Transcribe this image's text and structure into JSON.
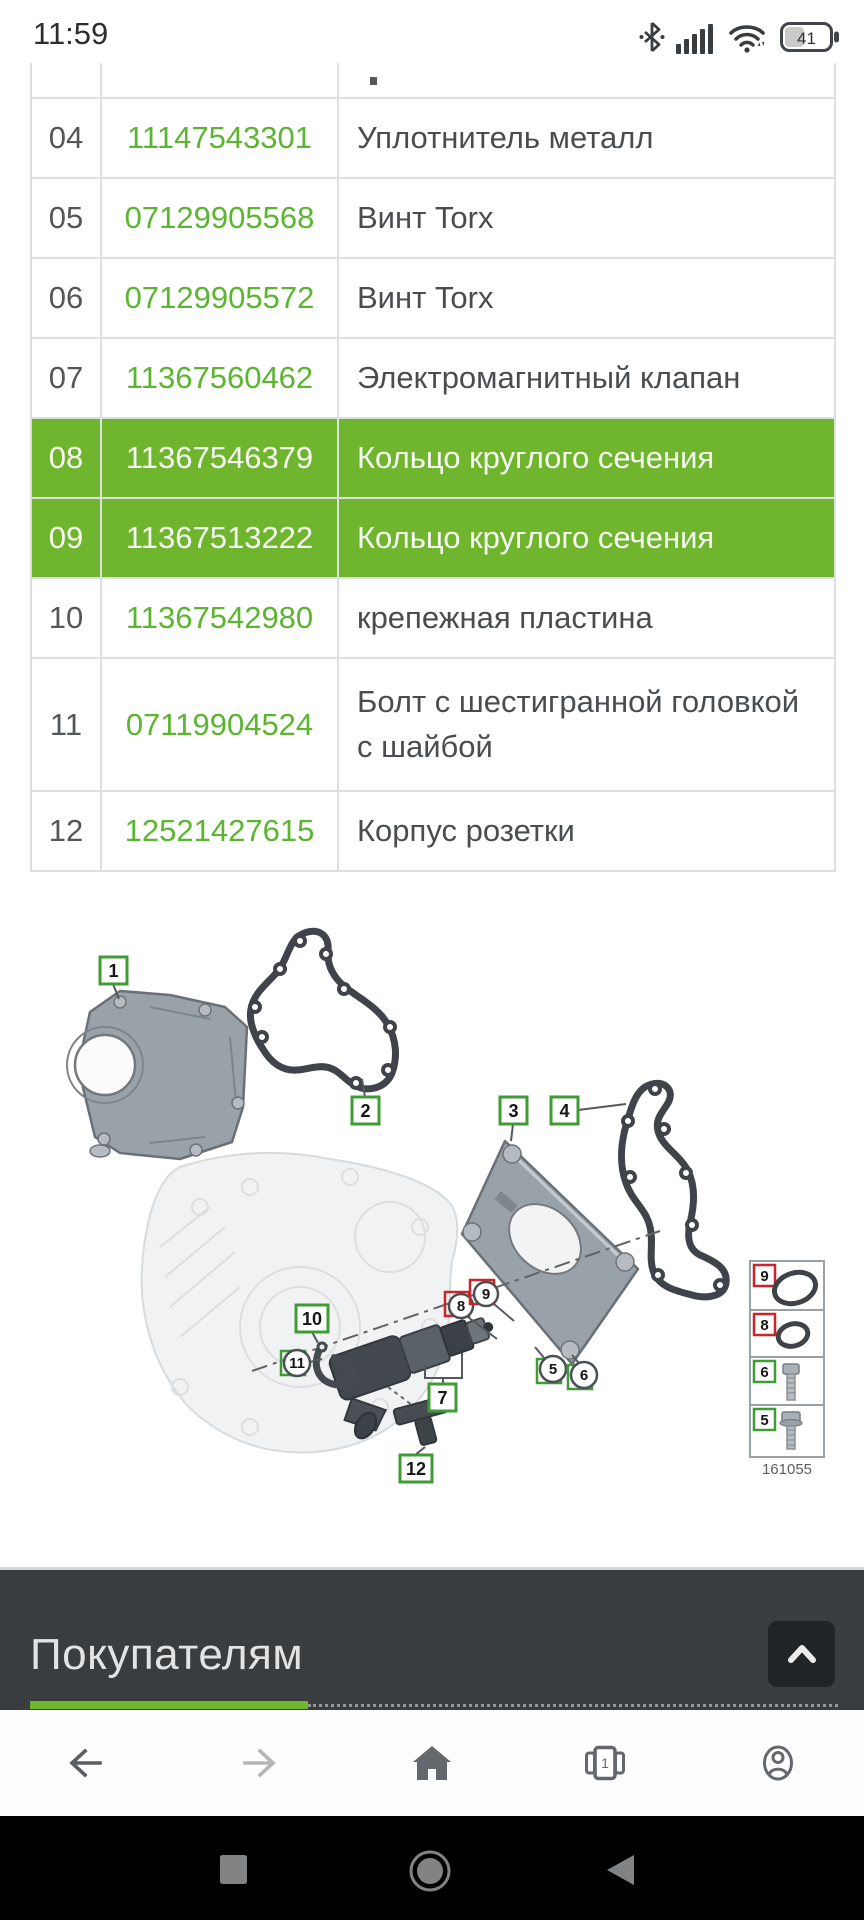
{
  "status_bar": {
    "time": "11:59",
    "battery_level": "41"
  },
  "parts_table": {
    "rows": [
      {
        "num": "04",
        "part_number": "11147543301",
        "description": "Уплотнитель металл",
        "highlighted": false
      },
      {
        "num": "05",
        "part_number": "07129905568",
        "description": "Винт Torx",
        "highlighted": false
      },
      {
        "num": "06",
        "part_number": "07129905572",
        "description": "Винт Torx",
        "highlighted": false
      },
      {
        "num": "07",
        "part_number": "11367560462",
        "description": "Электромагнитный клапан",
        "highlighted": false
      },
      {
        "num": "08",
        "part_number": "11367546379",
        "description": "Кольцо круглого сечения",
        "highlighted": true
      },
      {
        "num": "09",
        "part_number": "11367513222",
        "description": "Кольцо круглого сечения",
        "highlighted": true
      },
      {
        "num": "10",
        "part_number": "11367542980",
        "description": "крепежная пластина",
        "highlighted": false
      },
      {
        "num": "11",
        "part_number": "07119904524",
        "description": "Болт с шестигранной головкой с шайбой",
        "highlighted": false
      },
      {
        "num": "12",
        "part_number": "12521427615",
        "description": "Корпус розетки",
        "highlighted": false
      }
    ],
    "colors": {
      "accent_green": "#5cb531",
      "row_highlight": "#6fb52d"
    }
  },
  "diagram": {
    "callouts": {
      "n1": "1",
      "n2": "2",
      "n3": "3",
      "n4": "4",
      "n5": "5",
      "n6": "6",
      "n7": "7",
      "n8": "8",
      "n9": "9",
      "n10": "10",
      "n11": "11",
      "n12": "12"
    },
    "legend": {
      "rows": [
        {
          "label": "9"
        },
        {
          "label": "8"
        },
        {
          "label": "6"
        },
        {
          "label": "5"
        }
      ],
      "figure_number": "161055"
    }
  },
  "footer": {
    "title": "Покупателям"
  },
  "browser_nav": {
    "tab_count": "1"
  }
}
